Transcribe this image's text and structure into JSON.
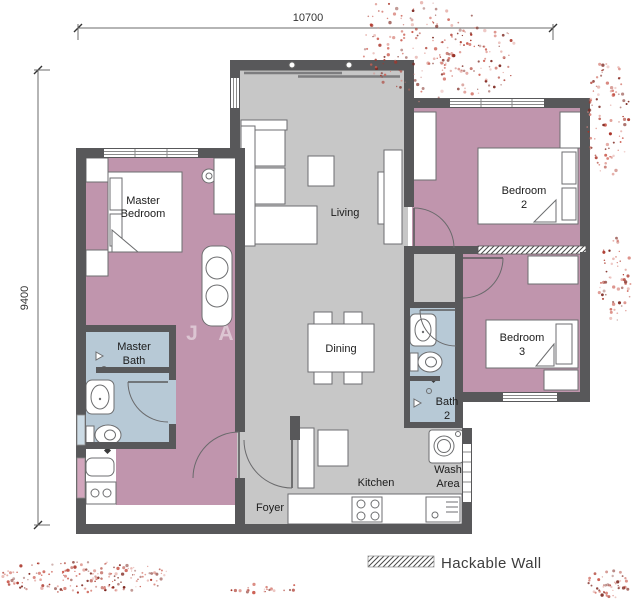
{
  "title": "Apartment Floor Plan",
  "dimensions": {
    "top": "10700",
    "left": "9400"
  },
  "rooms": {
    "master_bedroom": {
      "line1": "Master",
      "line2": "Bedroom"
    },
    "master_bath": {
      "line1": "Master",
      "line2": "Bath"
    },
    "living": {
      "line1": "Living"
    },
    "dining": {
      "line1": "Dining"
    },
    "bedroom2": {
      "line1": "Bedroom",
      "line2": "2"
    },
    "bedroom3": {
      "line1": "Bedroom",
      "line2": "3"
    },
    "bath2": {
      "line1": "Bath",
      "line2": "2"
    },
    "kitchen": {
      "line1": "Kitchen"
    },
    "wash_area": {
      "line1": "Wash",
      "line2": "Area"
    },
    "foyer": {
      "line1": "Foyer"
    }
  },
  "legend": {
    "hackable_wall_label": "Hackable Wall"
  },
  "watermark": {
    "letter1": "J",
    "letter2": "A"
  },
  "colors": {
    "wall": "#58585a",
    "bedroom_floor": "#c095ad",
    "bath_floor": "#b7c9d6",
    "living_floor": "#c7c7c7",
    "furniture_outline": "#6d6e70",
    "dot_red": "#a93226"
  },
  "decorations": {
    "palette": [
      "#a93226",
      "#7b241c",
      "#cd6155",
      "#d98880"
    ],
    "clusters": [
      {
        "cx": 420,
        "cy": 42,
        "rx": 58,
        "ry": 60,
        "count": 150,
        "seed": 11
      },
      {
        "cx": 478,
        "cy": 58,
        "rx": 40,
        "ry": 38,
        "count": 80,
        "seed": 22
      },
      {
        "cx": 608,
        "cy": 118,
        "rx": 22,
        "ry": 58,
        "count": 90,
        "seed": 33
      },
      {
        "cx": 614,
        "cy": 282,
        "rx": 18,
        "ry": 46,
        "count": 55,
        "seed": 44
      },
      {
        "cx": 82,
        "cy": 577,
        "rx": 92,
        "ry": 16,
        "count": 170,
        "seed": 55
      },
      {
        "cx": 265,
        "cy": 589,
        "rx": 48,
        "ry": 5,
        "count": 22,
        "seed": 66
      },
      {
        "cx": 610,
        "cy": 584,
        "rx": 24,
        "ry": 14,
        "count": 45,
        "seed": 77
      }
    ]
  }
}
